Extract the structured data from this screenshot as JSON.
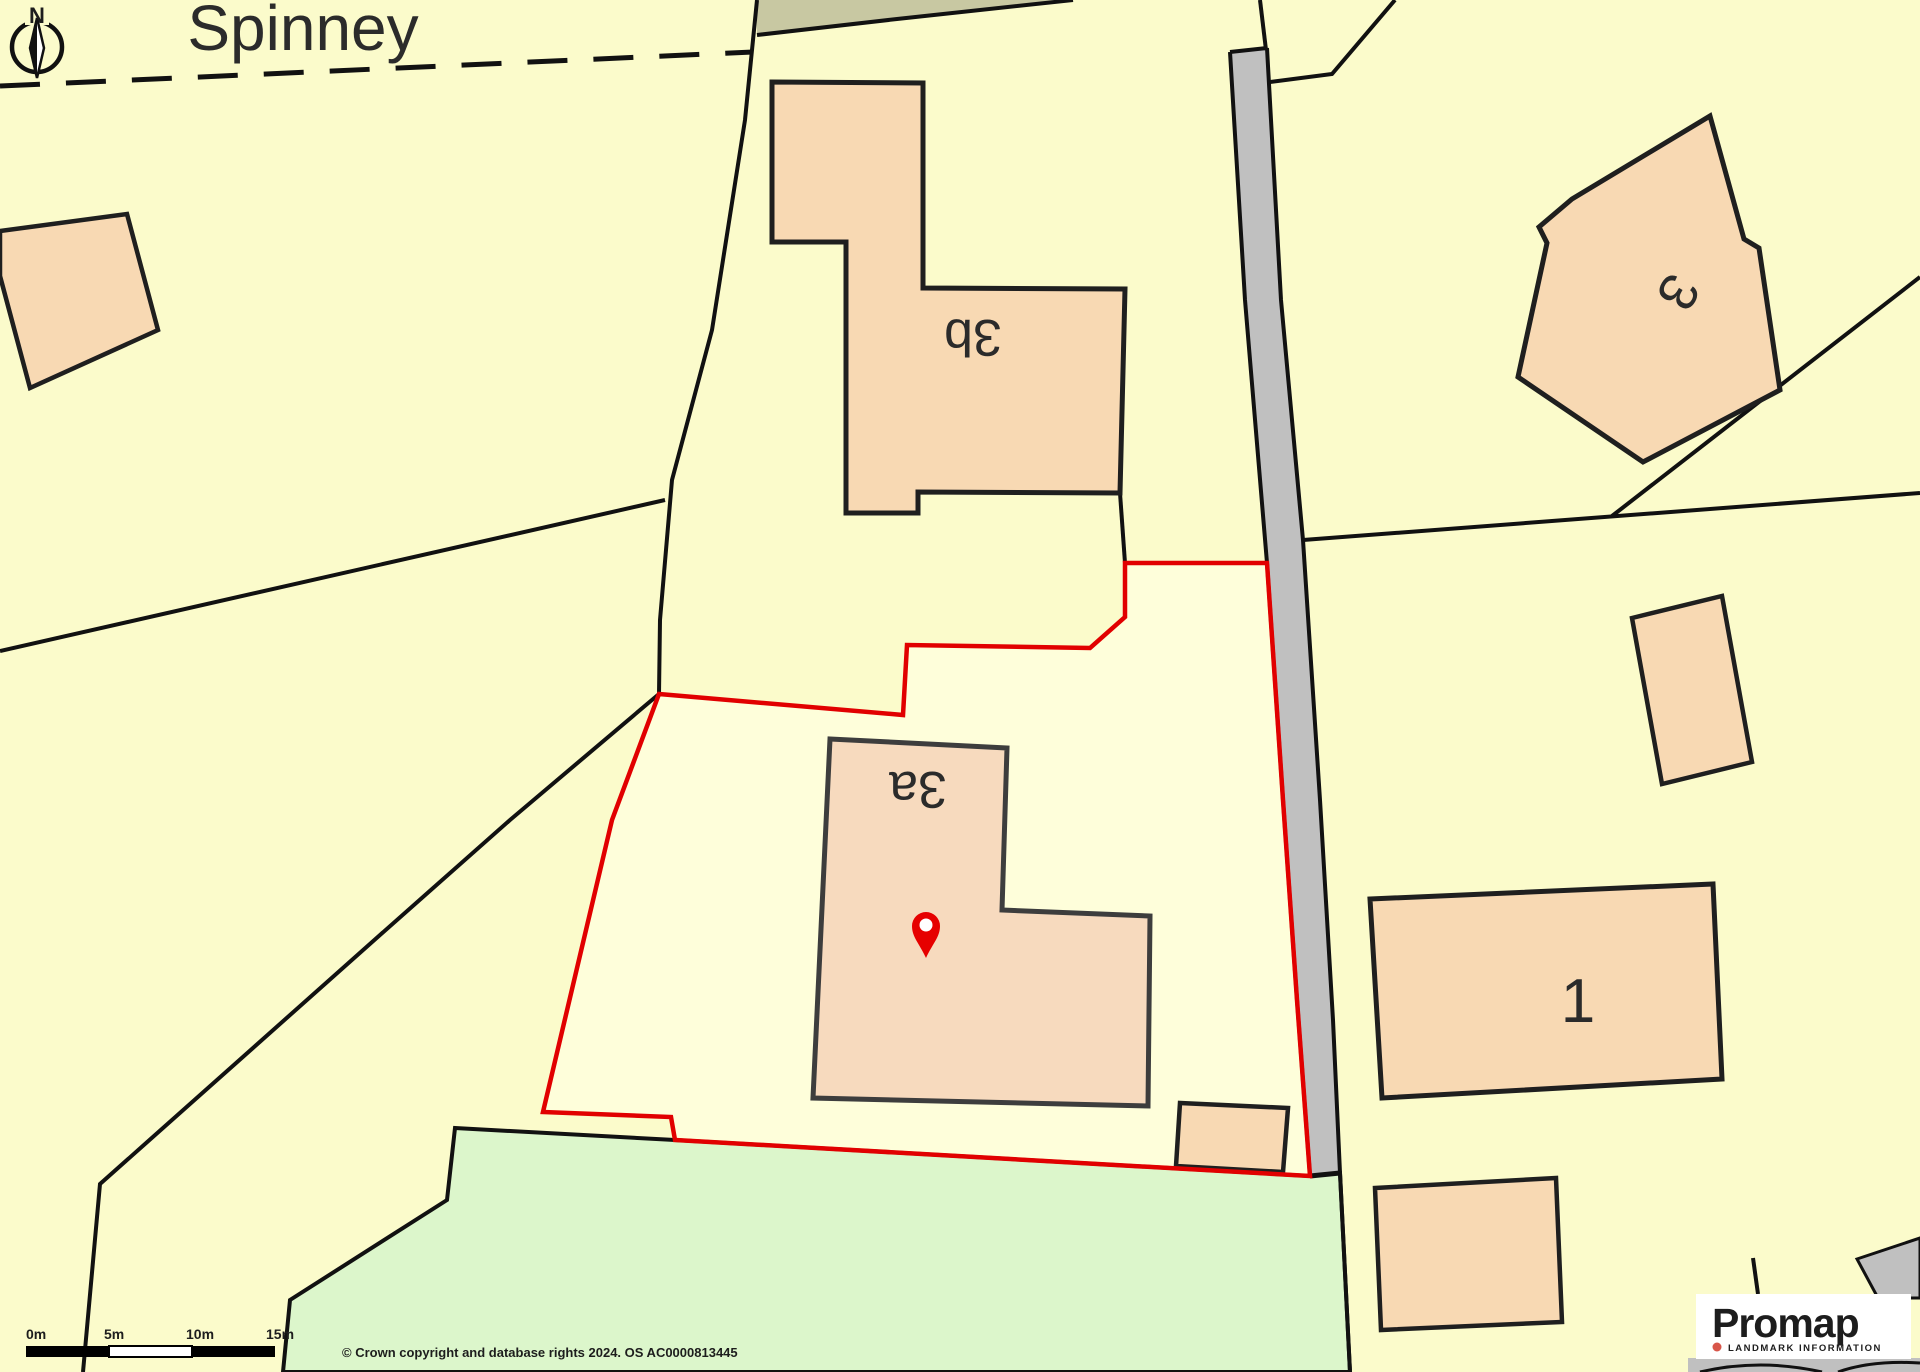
{
  "map": {
    "region_labels": {
      "spinney": "Spinney"
    },
    "building_labels": {
      "b3b": "3b",
      "b3a": "3a",
      "b3": "3",
      "b1": "1"
    },
    "compass_north": "N",
    "scale_ticks": [
      "0m",
      "5m",
      "10m",
      "15m"
    ],
    "attribution": "© Crown copyright and database rights 2024. OS AC0000813445",
    "colors": {
      "plot_yellow": "#fbfbcb",
      "subject_plot_fill": "#fefeda",
      "building_peach": "#f8d9b3",
      "building_3a_peach": "#f7dabe",
      "road_gray": "#c0c0c0",
      "field_green": "#dcf6cb",
      "woodland_olive": "#c8c8a2",
      "subject_boundary_red": "#e10000",
      "pin_red": "#e60000",
      "logo_dot": "#d8564a",
      "logo_text": "#3b3b33"
    }
  },
  "branding": {
    "logo_text": "Promap",
    "tagline": "LANDMARK INFORMATION"
  }
}
